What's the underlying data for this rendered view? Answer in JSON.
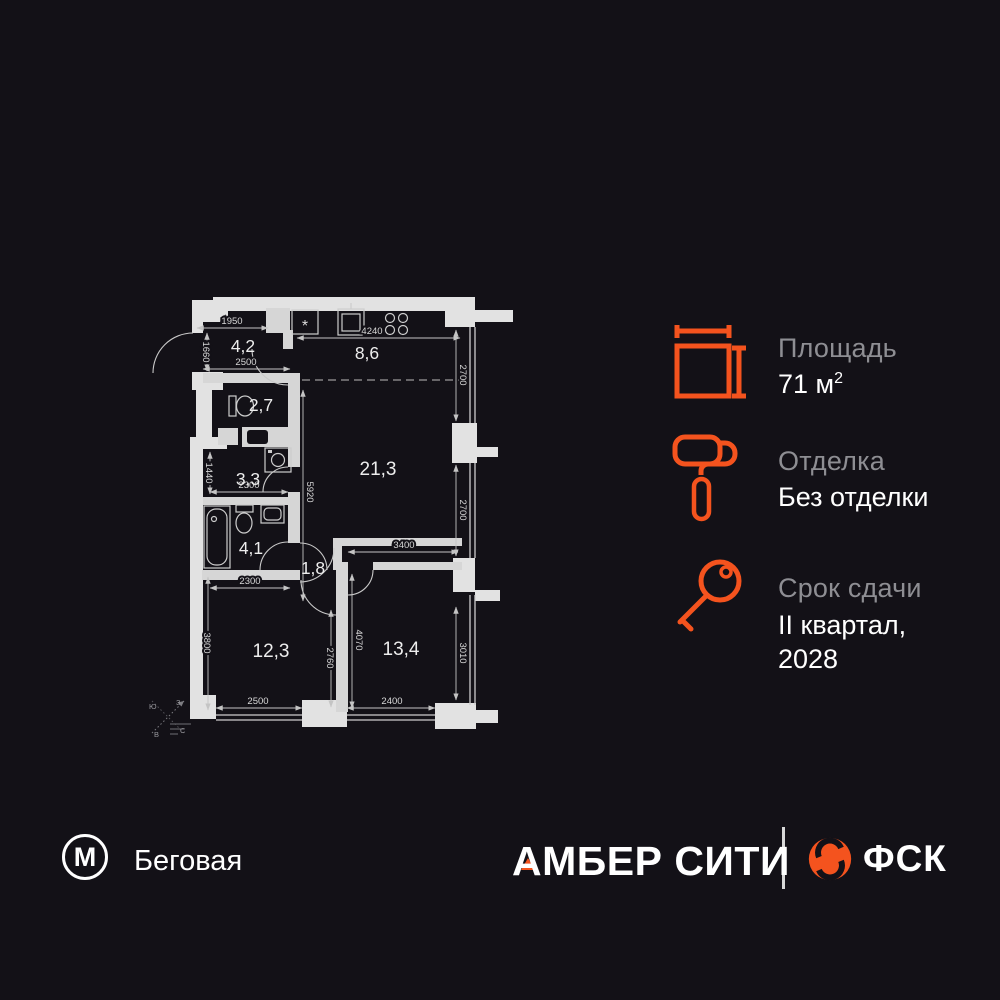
{
  "colors": {
    "accent": "#F4531E",
    "background": "#131117",
    "wall": "#E2E2E2"
  },
  "plan": {
    "rooms": {
      "hallway": "4,2",
      "kitchen": "8,6",
      "wc": "2,7",
      "storage": "3,3",
      "bathroom": "4,1",
      "corridor": "1,8",
      "living": "21,3",
      "bedroom": "12,3",
      "bedroom2": "13,4"
    },
    "dims": {
      "hall_top": "1950",
      "hall_left": "1660",
      "hall_bottom": "2500",
      "kitchen_top": "4240",
      "kitchen_window": "2700",
      "height_mid": "5920",
      "storage_left": "1440",
      "storage_width": "2300",
      "bedroom_top": "2300",
      "living_width": "3400",
      "living_window": "2700",
      "bedroom_left": "3800",
      "mid_wall": "2760",
      "bedroom2_left": "4070",
      "bedroom2_window": "3010",
      "bedroom_bottom": "2500",
      "bedroom2_bottom": "2400"
    },
    "kitchen_star": "*",
    "compass": {
      "top_left": "Ю",
      "top_right": "З",
      "bottom_left": "В",
      "bottom_right": "С"
    }
  },
  "info": {
    "area": {
      "label": "Площадь",
      "value": "71 м",
      "sup": "2"
    },
    "finishing": {
      "label": "Отделка",
      "value": "Без отделки"
    },
    "completion": {
      "label": "Срок сдачи",
      "line1": "II квартал,",
      "line2": "2028"
    }
  },
  "footer": {
    "metro": "М",
    "station": "Беговая",
    "project": "АМБЕР СИТИ",
    "developer": "ФСК"
  }
}
